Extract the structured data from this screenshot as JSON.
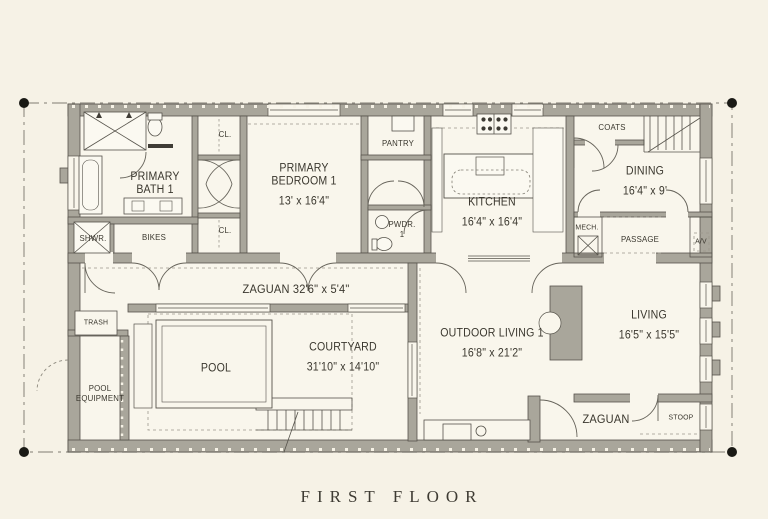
{
  "sheet": {
    "title": "FIRST FLOOR"
  },
  "colors": {
    "background": "#f6f2e6",
    "wall": "#a9a69b",
    "line": "#56534b",
    "text": "#3a372e"
  },
  "rooms": {
    "primary_bath": {
      "name": "PRIMARY BATH 1"
    },
    "shwr": {
      "name": "SHWR."
    },
    "bikes": {
      "name": "BIKES"
    },
    "cl_upper": {
      "name": "CL."
    },
    "cl_lower": {
      "name": "CL."
    },
    "primary_bedroom": {
      "name": "PRIMARY BEDROOM 1",
      "dims": "13' x 16'4\""
    },
    "pantry": {
      "name": "PANTRY"
    },
    "pwdr": {
      "name": "PWDR. 1"
    },
    "kitchen": {
      "name": "KITCHEN",
      "dims": "16'4\" x 16'4\""
    },
    "mech": {
      "name": "MECH."
    },
    "coats": {
      "name": "COATS"
    },
    "dining": {
      "name": "DINING",
      "dims": "16'4\" x 9'"
    },
    "passage": {
      "name": "PASSAGE"
    },
    "av": {
      "name": "A/V"
    },
    "zaguan": {
      "name": "ZAGUAN 32'6\" x 5'4\""
    },
    "trash": {
      "name": "TRASH"
    },
    "pool_equipment": {
      "name": "POOL EQUIPMENT"
    },
    "pool": {
      "name": "POOL"
    },
    "courtyard": {
      "name": "COURTYARD",
      "dims": "31'10\" x 14'10\""
    },
    "outdoor_living": {
      "name": "OUTDOOR LIVING 1",
      "dims": "16'8\" x 21'2\""
    },
    "living": {
      "name": "LIVING",
      "dims": "16'5\" x 15'5\""
    },
    "zaguan_entry": {
      "name": "ZAGUAN"
    },
    "stoop": {
      "name": "STOOP"
    }
  }
}
